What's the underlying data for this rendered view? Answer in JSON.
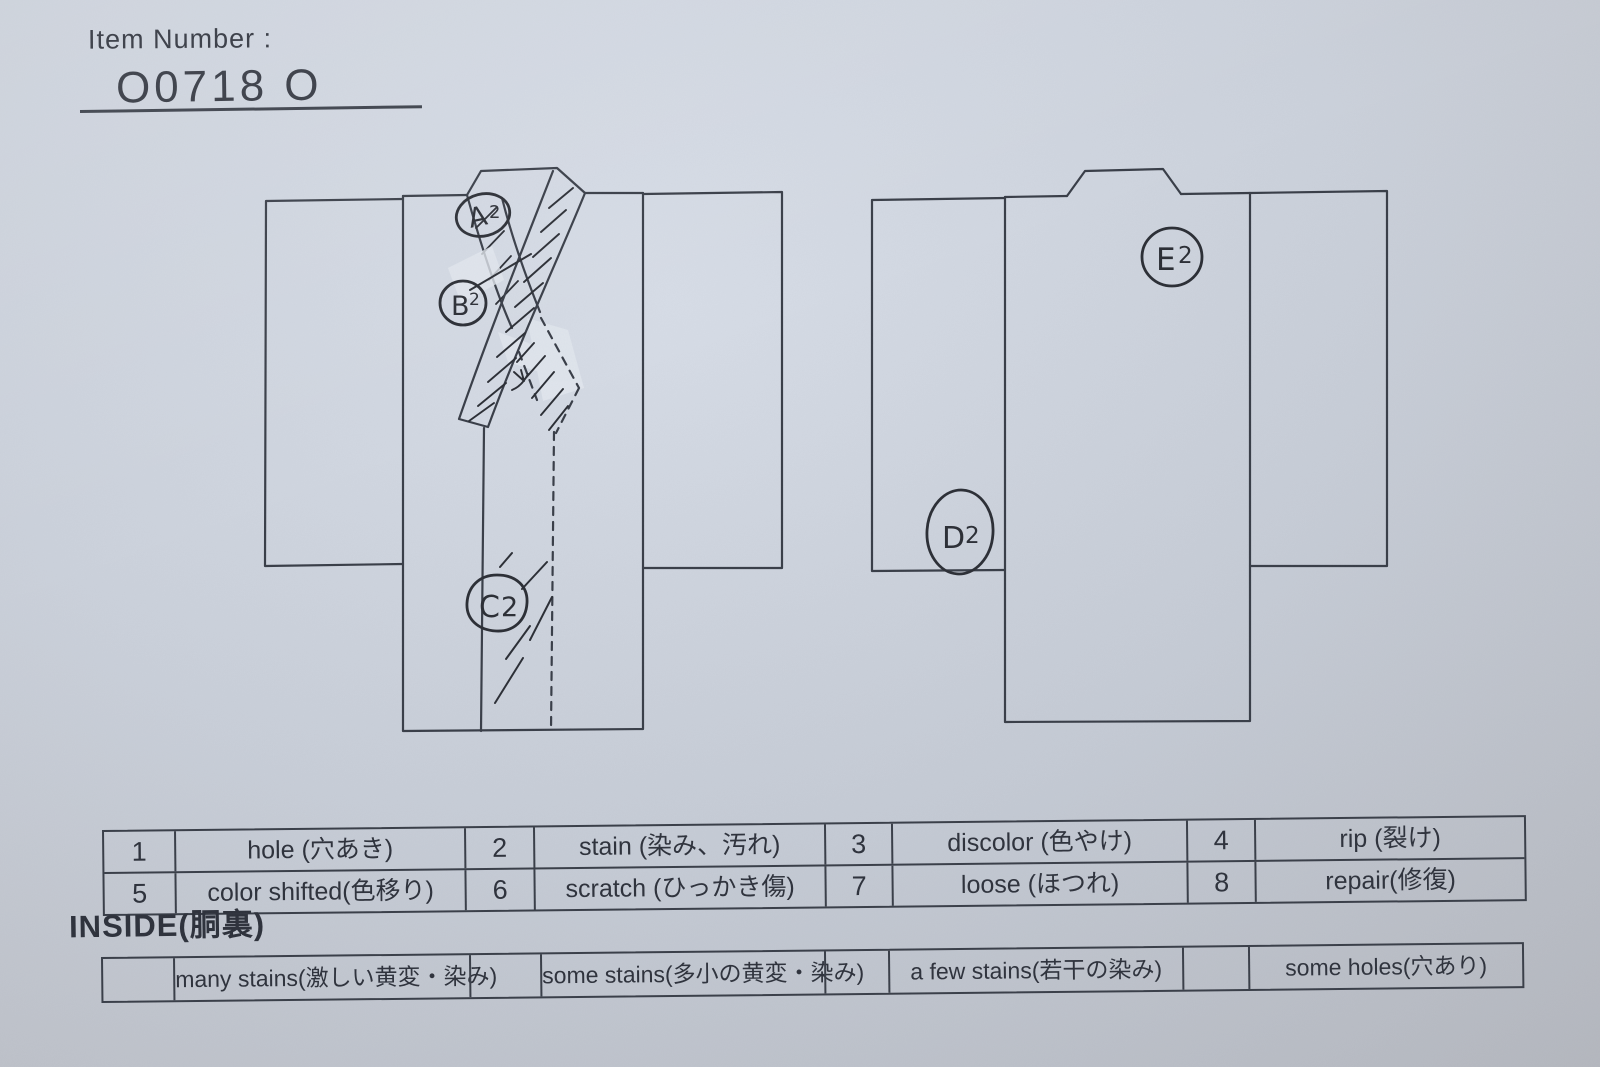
{
  "header": {
    "item_number_label": "Item Number :",
    "item_number_value": "O0718  O"
  },
  "legend": {
    "items": [
      {
        "num": "1",
        "label": "hole (穴あき)"
      },
      {
        "num": "2",
        "label": "stain (染み、汚れ)"
      },
      {
        "num": "3",
        "label": "discolor (色やけ)"
      },
      {
        "num": "4",
        "label": "rip (裂け)"
      },
      {
        "num": "5",
        "label": "color shifted(色移り)"
      },
      {
        "num": "6",
        "label": "scratch (ひっかき傷)"
      },
      {
        "num": "7",
        "label": "loose (ほつれ)"
      },
      {
        "num": "8",
        "label": "repair(修復)"
      }
    ]
  },
  "inside": {
    "heading": "INSIDE(胴裏)",
    "items": [
      {
        "label": "many stains(激しい黄変・染み)"
      },
      {
        "label": "some stains(多小の黄変・染み)"
      },
      {
        "label": "a few stains(若干の染み)"
      },
      {
        "label": "some holes(穴あり)"
      }
    ]
  },
  "annotations": [
    {
      "id": "A2",
      "letter": "A",
      "digit": "2",
      "location": "front-collar-top"
    },
    {
      "id": "B2",
      "letter": "B",
      "digit": "2",
      "location": "front-collar-left"
    },
    {
      "id": "C2",
      "letter": "C",
      "digit": "2",
      "location": "front-lower-center"
    },
    {
      "id": "D2",
      "letter": "D",
      "digit": "2",
      "location": "back-left-sleeve"
    },
    {
      "id": "E2",
      "letter": "E",
      "digit": "2",
      "location": "back-upper-right"
    }
  ],
  "colors": {
    "paper": "#ccd2dc",
    "paper_light": "#d7dde7",
    "paper_dark": "#c1c4cb",
    "ink": "#383d47",
    "pen": "#2a2d34",
    "text": "#2c303a",
    "tape": "#e3e8ef"
  }
}
